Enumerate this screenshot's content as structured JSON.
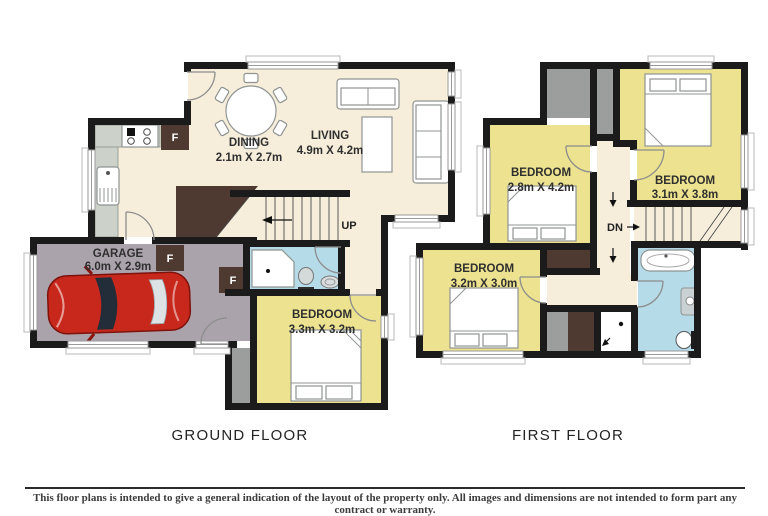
{
  "colors": {
    "wall": "#1b1b1b",
    "floor_cream": "#f6eedb",
    "floor_yellow": "#ece28f",
    "floor_blue": "#b5dbe8",
    "floor_garage": "#aba3ac",
    "floor_gray": "#9b9e9d",
    "storage_brown": "#4e3a30",
    "counter_gray": "#ccd1c9",
    "car_red": "#c8281c"
  },
  "ground_floor": {
    "title": "GROUND FLOOR",
    "stair_label": "UP",
    "appliance_label": "F",
    "rooms": {
      "dining": {
        "name": "DINING",
        "dims": "2.1m X 2.7m"
      },
      "living": {
        "name": "LIVING",
        "dims": "4.9m X 4.2m"
      },
      "garage": {
        "name": "GARAGE",
        "dims": "6.0m X 2.9m"
      },
      "bedroom": {
        "name": "BEDROOM",
        "dims": "3.3m X 3.2m"
      }
    }
  },
  "first_floor": {
    "title": "FIRST FLOOR",
    "stair_label": "DN",
    "rooms": {
      "bedroom_left": {
        "name": "BEDROOM",
        "dims": "2.8m X 4.2m"
      },
      "bedroom_right": {
        "name": "BEDROOM",
        "dims": "3.1m X 3.8m"
      },
      "bedroom_lower": {
        "name": "BEDROOM",
        "dims": "3.2m X 3.0m"
      }
    }
  },
  "footer": {
    "disclaimer": "This floor plans is intended to give a general indication of the layout of the property only. All images and dimensions are not intended to form part any contract or warranty."
  }
}
